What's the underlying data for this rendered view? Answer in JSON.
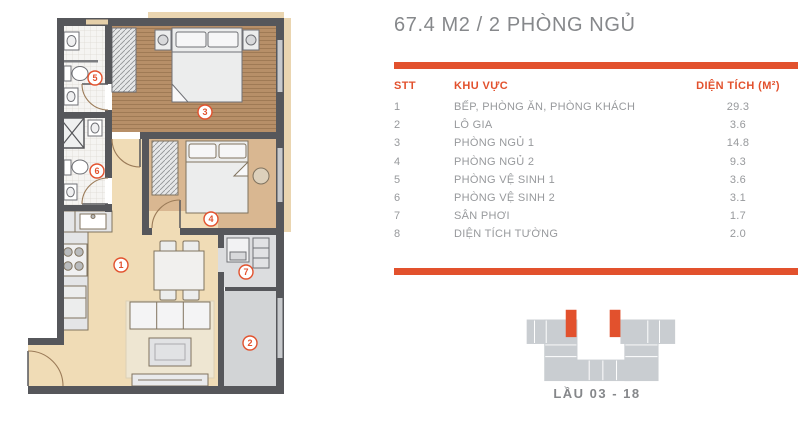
{
  "title": "67.4 M2 / 2 PHÒNG NGỦ",
  "table": {
    "headers": {
      "stt": "STT",
      "khu_vuc": "KHU VỰC",
      "dien_tich": "DIỆN TÍCH (M²)"
    },
    "rows": [
      {
        "stt": "1",
        "khu_vuc": "BẾP, PHÒNG ĂN, PHÒNG KHÁCH",
        "dien_tich": "29.3"
      },
      {
        "stt": "2",
        "khu_vuc": "LÔ GIA",
        "dien_tich": "3.6"
      },
      {
        "stt": "3",
        "khu_vuc": "PHÒNG NGỦ 1",
        "dien_tich": "14.8"
      },
      {
        "stt": "4",
        "khu_vuc": "PHÒNG NGỦ 2",
        "dien_tich": "9.3"
      },
      {
        "stt": "5",
        "khu_vuc": "PHÒNG VỆ SINH 1",
        "dien_tich": "3.6"
      },
      {
        "stt": "6",
        "khu_vuc": "PHÒNG VỆ SINH 2",
        "dien_tich": "3.1"
      },
      {
        "stt": "7",
        "khu_vuc": "SÂN PHƠI",
        "dien_tich": "1.7"
      },
      {
        "stt": "8",
        "khu_vuc": "DIỆN TÍCH TƯỜNG",
        "dien_tich": "2.0"
      }
    ]
  },
  "floor_plan": {
    "room_labels": {
      "living": "1",
      "loggia": "2",
      "bedroom1": "3",
      "bedroom2": "4",
      "bath1": "5",
      "bath2": "6",
      "drying": "7"
    }
  },
  "location_key": {
    "floors_label": "LẦU 03 - 18"
  },
  "colors": {
    "accent": "#e2512d",
    "title_text": "#86888b",
    "table_text": "#97999c",
    "wall": "#56575b",
    "wood_floor": "#b78f68",
    "living_floor": "#f0dcb6",
    "bedroom2_floor": "#d9b791",
    "loggia_floor": "#d2d4d6",
    "building_key": "#c9cdd1"
  }
}
